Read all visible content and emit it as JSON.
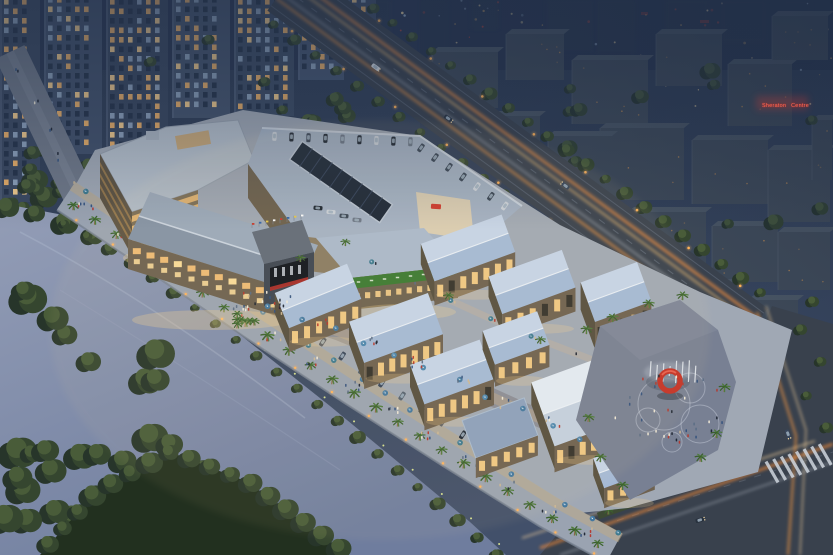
{
  "signage": {
    "distant_building_sign": "Sheraton Centre"
  },
  "colors": {
    "sky": "#2e3c54",
    "water": "#8792ae",
    "tree": "#36462f",
    "roof_blue": "#b9cbe2",
    "facade_glow": "#f3cd8d",
    "light_trail": "#ff9440",
    "ring_sculpture": "#c43327",
    "sign_red": "#ff6a52",
    "umbrella": "#44789f",
    "road": "#39414d"
  }
}
